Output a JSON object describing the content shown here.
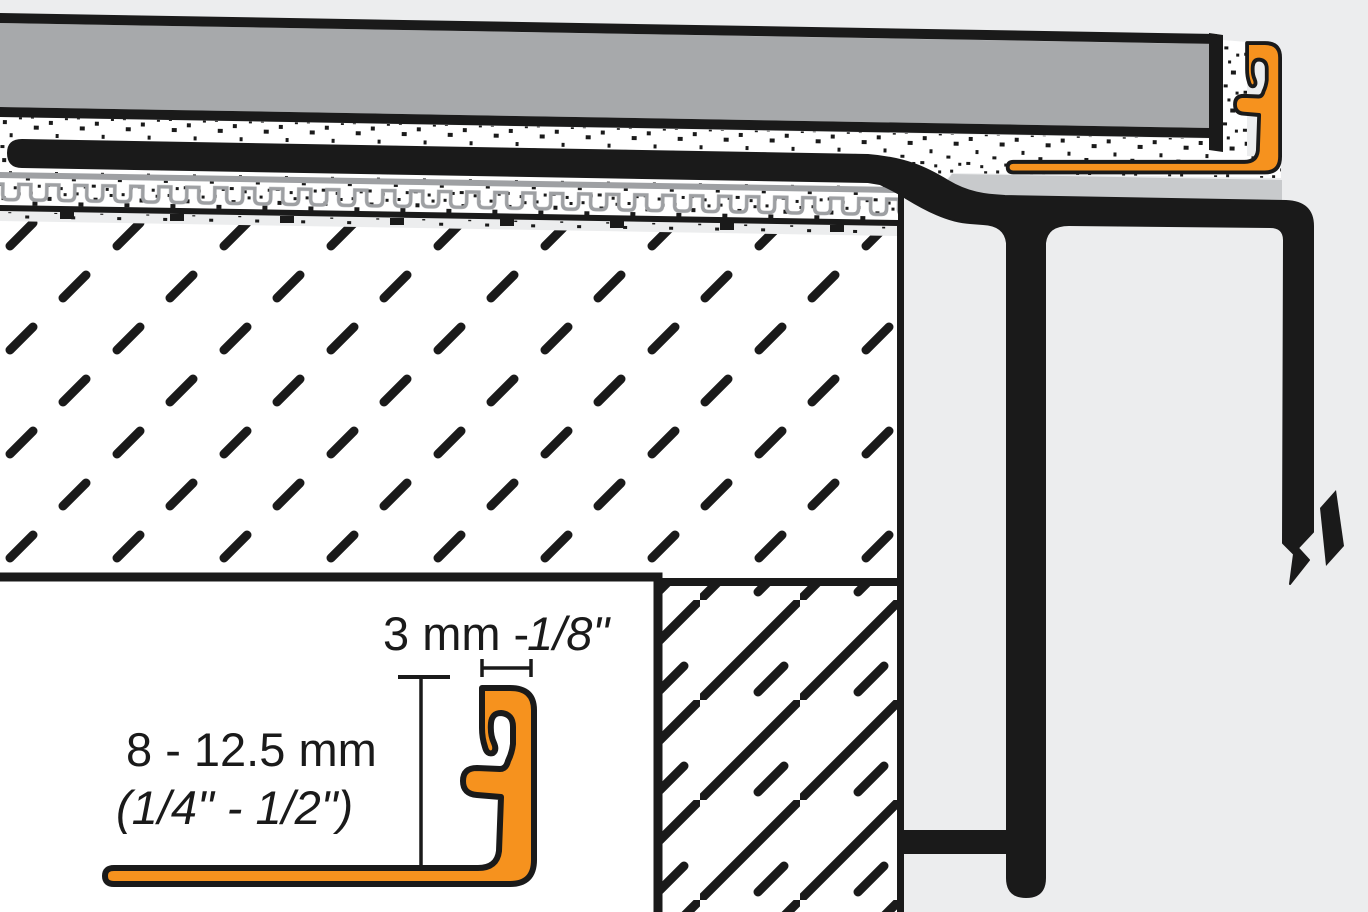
{
  "inset_detail": {
    "width_dimension": {
      "metric": "3 mm - ",
      "imperial_italic": "1/8\""
    },
    "height_dimension": {
      "metric": "8 - 12.5 mm",
      "imperial_italic": "(1/4\" - 1/2\")"
    }
  },
  "colors": {
    "profile_orange": "#F6921E",
    "tile_gray": "#A7A9AB",
    "support_plate_gray": "#C8CACC",
    "membrane_gray": "#9EA0A3",
    "outline_black": "#1A1A1A",
    "background_gray": "#ECEDEE",
    "white": "#FFFFFF"
  }
}
